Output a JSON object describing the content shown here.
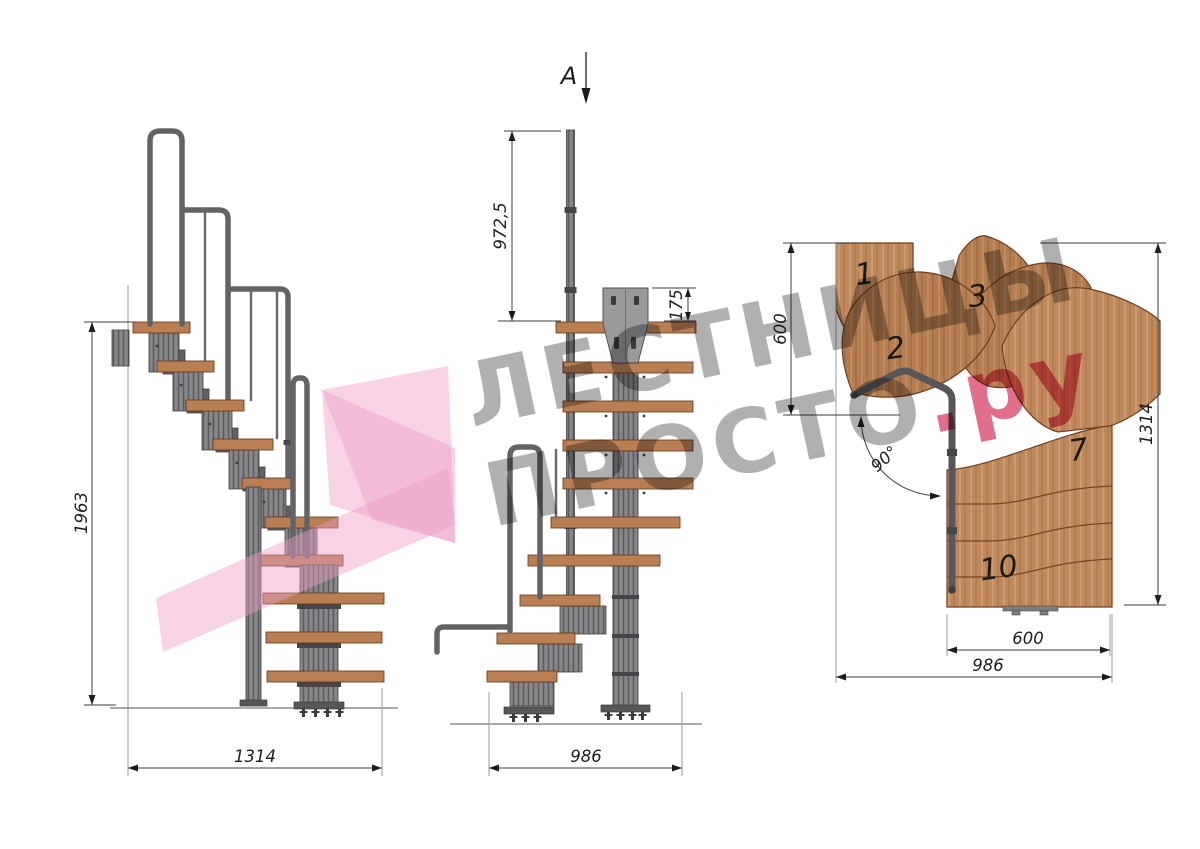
{
  "watermark": {
    "line1": "ЛЕСТНИЦЫ",
    "line2": "ПРОСТО",
    "line2_suffix": ".ру"
  },
  "section_cut": {
    "label": "A"
  },
  "side_view": {
    "total_height": "1963",
    "total_length": "1314"
  },
  "front_view": {
    "handrail_height": "972,5",
    "bracket_height": "175",
    "total_width": "986"
  },
  "plan_view": {
    "landing_depth": "600",
    "total_depth": "1314",
    "flight_width": "600",
    "total_width": "986",
    "turn_angle": "90°",
    "step_numbers": {
      "first": "1",
      "second": "2",
      "third": "3",
      "seventh": "7",
      "tenth": "10"
    }
  },
  "colors": {
    "wood": "#c0895c",
    "metal": "#7a7a7d",
    "dimension": "#1d1d1d",
    "watermark_gray": "#686868",
    "watermark_pink": "#d6466a"
  }
}
